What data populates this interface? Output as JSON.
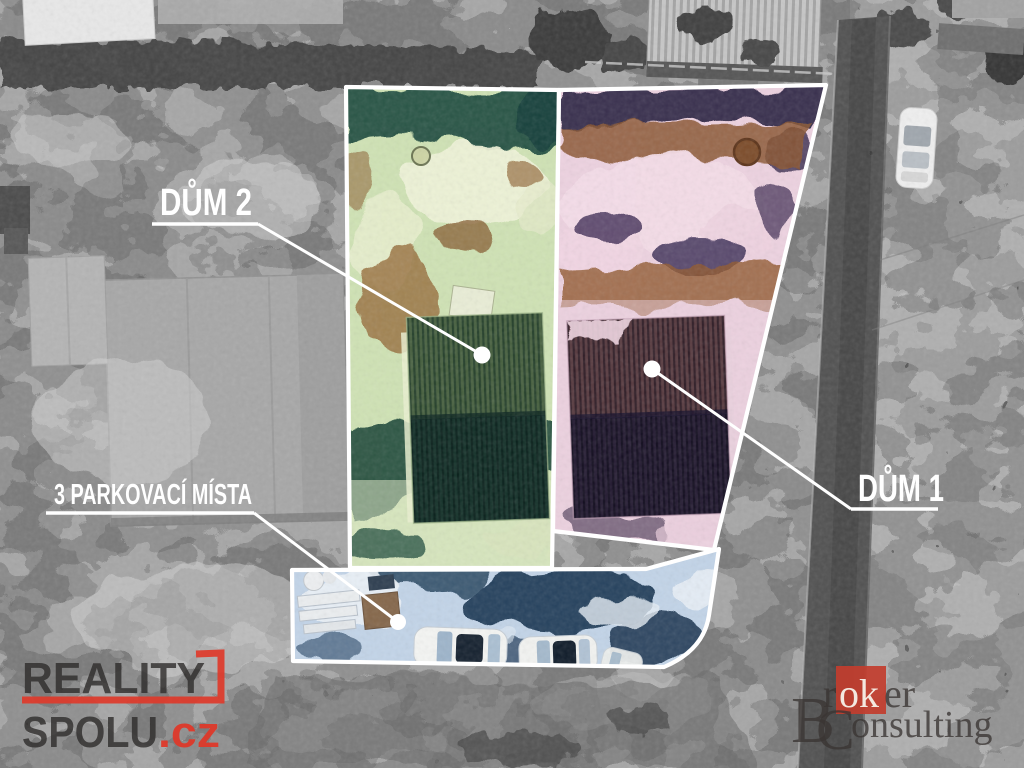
{
  "annotations": {
    "label_color": "#ffffff",
    "house2": {
      "label": "DŮM 2",
      "tint": "#cfe2b4"
    },
    "house1": {
      "label": "DŮM 1",
      "tint": "#edd2e0"
    },
    "parking": {
      "label": "3 PARKOVACÍ MÍSTA",
      "tint": "#c2d4e8"
    }
  },
  "watermarks": {
    "reality": {
      "word1": "REALITY",
      "word2": "SPOLU",
      "tld": ".cz",
      "accent": "#de392a",
      "text_color": "#2e2c2b"
    },
    "broker": {
      "part_b": "B",
      "part_r": "r",
      "part_ok": "ok",
      "part_er": "er",
      "part_c": "C",
      "part_onsulting": "onsulting",
      "accent": "#c23d2e",
      "text_color": "#3a3533"
    }
  }
}
